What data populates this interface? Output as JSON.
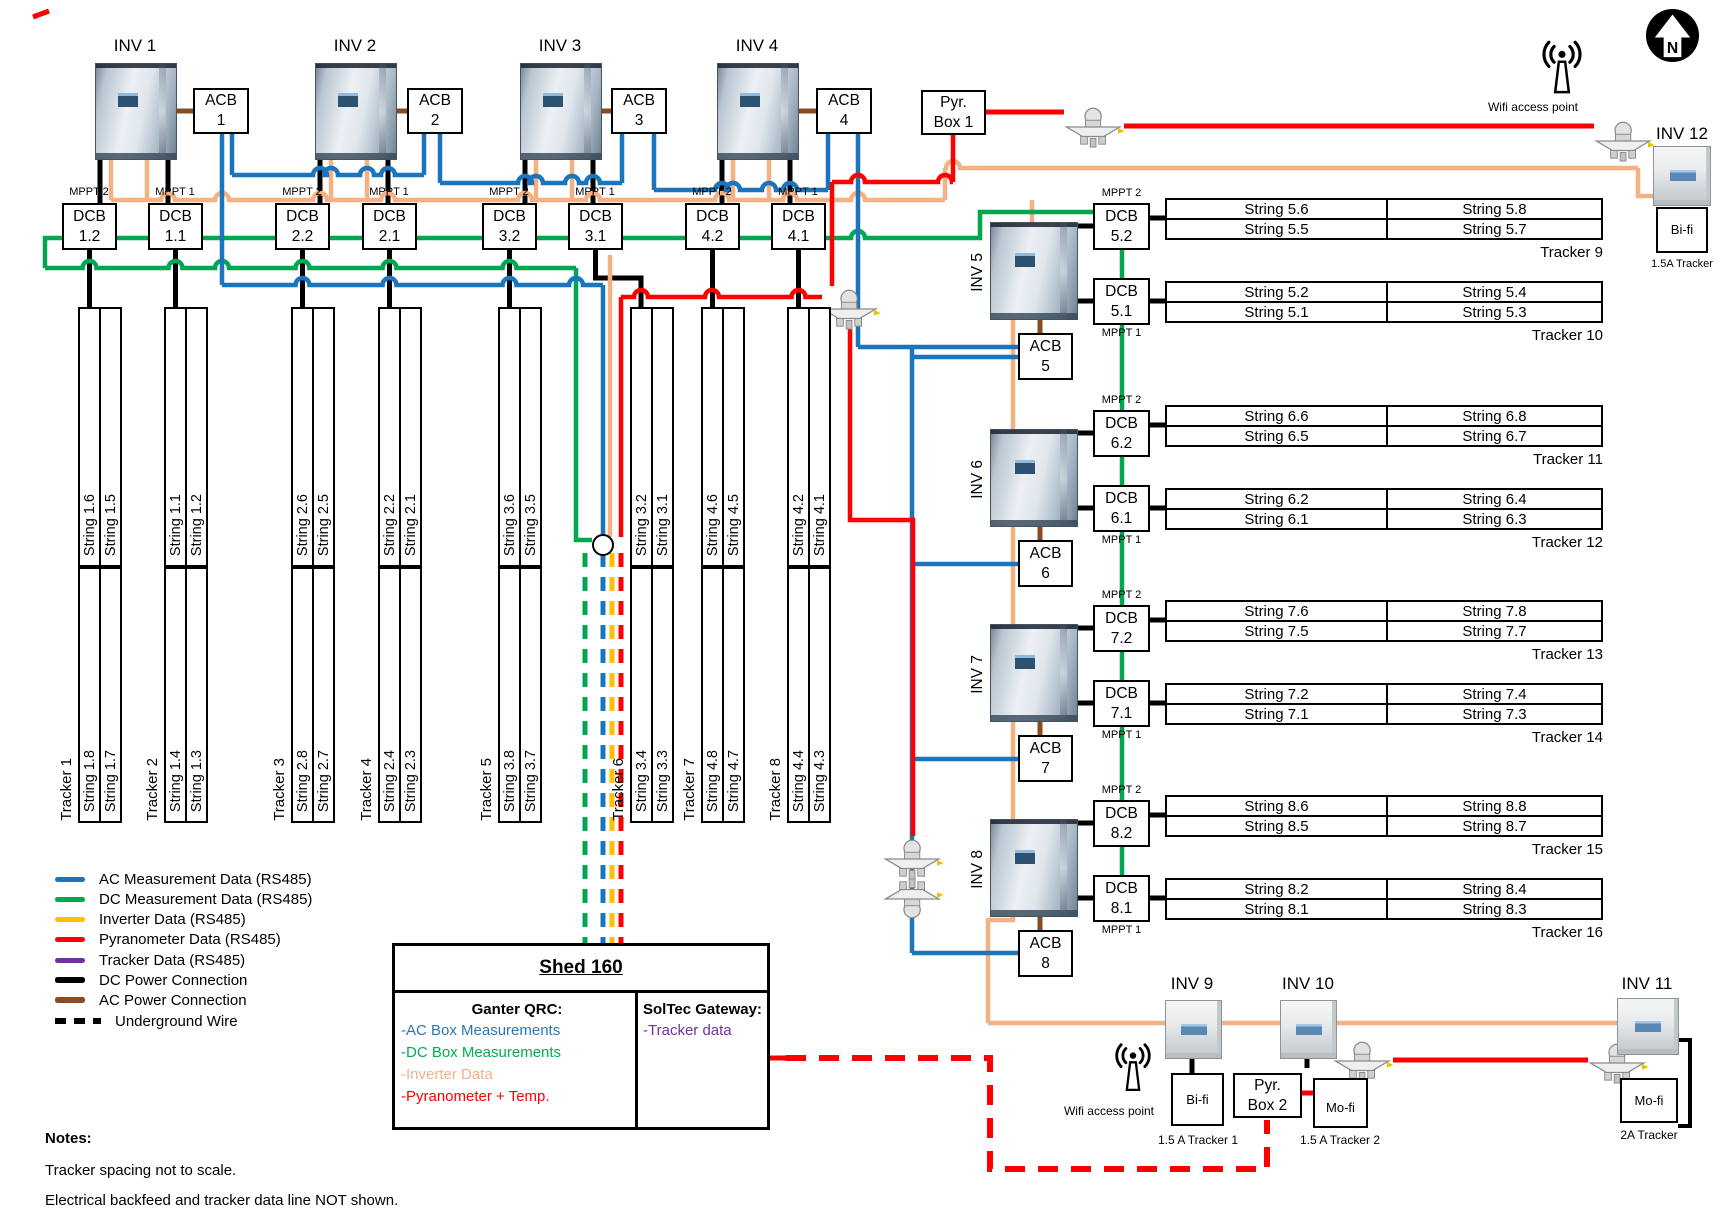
{
  "colors": {
    "ac_data": "#1B75BC",
    "dc_data": "#00A650",
    "inverter_data": "#FFC000",
    "inverter_data_wire": "#F4B183",
    "pyranometer_data": "#FF0000",
    "tracker_data": "#7030A0",
    "dc_power": "#000000",
    "ac_power": "#8A4B20"
  },
  "top_section": {
    "inverters": [
      {
        "label": "INV 1"
      },
      {
        "label": "INV 2"
      },
      {
        "label": "INV 3"
      },
      {
        "label": "INV 4"
      }
    ],
    "acbs": [
      [
        "ACB",
        "1"
      ],
      [
        "ACB",
        "2"
      ],
      [
        "ACB",
        "3"
      ],
      [
        "ACB",
        "4"
      ]
    ],
    "pyr_box_1": [
      "Pyr.",
      "Box 1"
    ],
    "dcbs": [
      {
        "mppt": "MPPT 2",
        "name": [
          "DCB",
          "1.2"
        ]
      },
      {
        "mppt": "MPPT 1",
        "name": [
          "DCB",
          "1.1"
        ]
      },
      {
        "mppt": "MPPT 2",
        "name": [
          "DCB",
          "2.2"
        ]
      },
      {
        "mppt": "MPPT 1",
        "name": [
          "DCB",
          "2.1"
        ]
      },
      {
        "mppt": "MPPT 2",
        "name": [
          "DCB",
          "3.2"
        ]
      },
      {
        "mppt": "MPPT 1",
        "name": [
          "DCB",
          "3.1"
        ]
      },
      {
        "mppt": "MPPT 2",
        "name": [
          "DCB",
          "4.2"
        ]
      },
      {
        "mppt": "MPPT 1",
        "name": [
          "DCB",
          "4.1"
        ]
      }
    ]
  },
  "left_trackers": [
    {
      "label": "Tracker 1",
      "top_strings": [
        "String 1.6",
        "String 1.5"
      ],
      "bottom_strings": [
        "String 1.8",
        "String 1.7"
      ]
    },
    {
      "label": "Tracker 2",
      "top_strings": [
        "String 1.1",
        "String 1.2"
      ],
      "bottom_strings": [
        "String 1.4",
        "String 1.3"
      ]
    },
    {
      "label": "Tracker 3",
      "top_strings": [
        "String 2.6",
        "String 2.5"
      ],
      "bottom_strings": [
        "String 2.8",
        "String 2.7"
      ]
    },
    {
      "label": "Tracker 4",
      "top_strings": [
        "String 2.2",
        "String 2.1"
      ],
      "bottom_strings": [
        "String 2.4",
        "String 2.3"
      ]
    },
    {
      "label": "Tracker 5",
      "top_strings": [
        "String 3.6",
        "String 3.5"
      ],
      "bottom_strings": [
        "String 3.8",
        "String 3.7"
      ]
    },
    {
      "label": "Tracker 6",
      "top_strings": [
        "String 3.2",
        "String 3.1"
      ],
      "bottom_strings": [
        "String 3.4",
        "String 3.3"
      ]
    },
    {
      "label": "Tracker 7",
      "top_strings": [
        "String 4.6",
        "String 4.5"
      ],
      "bottom_strings": [
        "String 4.8",
        "String 4.7"
      ]
    },
    {
      "label": "Tracker 8",
      "top_strings": [
        "String 4.2",
        "String 4.1"
      ],
      "bottom_strings": [
        "String 4.4",
        "String 4.3"
      ]
    }
  ],
  "right_units": [
    {
      "inverter": "INV 5",
      "acb": [
        "ACB",
        "5"
      ],
      "dcb_top": {
        "mppt": "MPPT 2",
        "name": [
          "DCB",
          "5.2"
        ]
      },
      "dcb_bottom": {
        "mppt": "MPPT 1",
        "name": [
          "DCB",
          "5.1"
        ]
      },
      "table_top": {
        "rows": [
          [
            "String 5.6",
            "String 5.8"
          ],
          [
            "String 5.5",
            "String 5.7"
          ]
        ],
        "tracker": "Tracker 9"
      },
      "table_bottom": {
        "rows": [
          [
            "String 5.2",
            "String 5.4"
          ],
          [
            "String 5.1",
            "String 5.3"
          ]
        ],
        "tracker": "Tracker 10"
      }
    },
    {
      "inverter": "INV 6",
      "acb": [
        "ACB",
        "6"
      ],
      "dcb_top": {
        "mppt": "MPPT 2",
        "name": [
          "DCB",
          "6.2"
        ]
      },
      "dcb_bottom": {
        "mppt": "MPPT 1",
        "name": [
          "DCB",
          "6.1"
        ]
      },
      "table_top": {
        "rows": [
          [
            "String 6.6",
            "String 6.8"
          ],
          [
            "String 6.5",
            "String 6.7"
          ]
        ],
        "tracker": "Tracker 11"
      },
      "table_bottom": {
        "rows": [
          [
            "String 6.2",
            "String 6.4"
          ],
          [
            "String 6.1",
            "String 6.3"
          ]
        ],
        "tracker": "Tracker 12"
      }
    },
    {
      "inverter": "INV 7",
      "acb": [
        "ACB",
        "7"
      ],
      "dcb_top": {
        "mppt": "MPPT 2",
        "name": [
          "DCB",
          "7.2"
        ]
      },
      "dcb_bottom": {
        "mppt": "MPPT 1",
        "name": [
          "DCB",
          "7.1"
        ]
      },
      "table_top": {
        "rows": [
          [
            "String 7.6",
            "String 7.8"
          ],
          [
            "String 7.5",
            "String 7.7"
          ]
        ],
        "tracker": "Tracker 13"
      },
      "table_bottom": {
        "rows": [
          [
            "String 7.2",
            "String 7.4"
          ],
          [
            "String 7.1",
            "String 7.3"
          ]
        ],
        "tracker": "Tracker 14"
      }
    },
    {
      "inverter": "INV 8",
      "acb": [
        "ACB",
        "8"
      ],
      "dcb_top": {
        "mppt": "MPPT 2",
        "name": [
          "DCB",
          "8.2"
        ]
      },
      "dcb_bottom": {
        "mppt": "MPPT 1",
        "name": [
          "DCB",
          "8.1"
        ]
      },
      "table_top": {
        "rows": [
          [
            "String 8.6",
            "String 8.8"
          ],
          [
            "String 8.5",
            "String 8.7"
          ]
        ],
        "tracker": "Tracker 15"
      },
      "table_bottom": {
        "rows": [
          [
            "String 8.2",
            "String 8.4"
          ],
          [
            "String 8.1",
            "String 8.3"
          ]
        ],
        "tracker": "Tracker 16"
      }
    }
  ],
  "far_right": {
    "wifi_label": "Wifi access point",
    "compass_letter": "N",
    "inv12_label": "INV 12",
    "inv12_box": "Bi-fi",
    "inv12_note": "1.5A Tracker"
  },
  "bottom_right": {
    "wifi_label": "Wifi access point",
    "inv9_label": "INV 9",
    "inv9_box": "Bi-fi",
    "inv9_note": "1.5 A Tracker 1",
    "inv10_label": "INV 10",
    "inv10_box": "Mo-fi",
    "inv10_note": "1.5 A Tracker 2",
    "pyr_box_2": [
      "Pyr.",
      "Box 2"
    ],
    "inv11_label": "INV 11",
    "inv11_box": "Mo-fi",
    "inv11_note": "2A Tracker"
  },
  "legend": [
    {
      "label": "AC Measurement Data (RS485)",
      "color": "#1B75BC",
      "style": "solid"
    },
    {
      "label": "DC Measurement Data (RS485)",
      "color": "#00A650",
      "style": "solid"
    },
    {
      "label": "Inverter Data (RS485)",
      "color": "#FFC000",
      "style": "solid"
    },
    {
      "label": "Pyranometer Data (RS485)",
      "color": "#FF0000",
      "style": "solid"
    },
    {
      "label": "Tracker Data (RS485)",
      "color": "#7030A0",
      "style": "solid"
    },
    {
      "label": "DC Power Connection",
      "color": "#000000",
      "style": "solid"
    },
    {
      "label": "AC Power Connection",
      "color": "#8A4B20",
      "style": "solid"
    },
    {
      "label": "Underground Wire",
      "color": "#000000",
      "style": "dashed"
    }
  ],
  "shed": {
    "title": "Shed 160",
    "left_heading": "Ganter QRC:",
    "left_items": [
      {
        "text": "-AC Box Measurements",
        "color": "#2E75B6"
      },
      {
        "text": "-DC Box Measurements",
        "color": "#00B050"
      },
      {
        "text": "-Inverter Data",
        "color": "#F4B183"
      },
      {
        "text": "-Pyranometer + Temp.",
        "color": "#FF0000"
      }
    ],
    "right_heading": "SolTec Gateway:",
    "right_items": [
      {
        "text": "-Tracker data",
        "color": "#7030A0"
      }
    ]
  },
  "notes": {
    "heading": "Notes:",
    "lines": [
      "Tracker spacing not to scale.",
      "Electrical backfeed and tracker data line NOT shown."
    ]
  }
}
